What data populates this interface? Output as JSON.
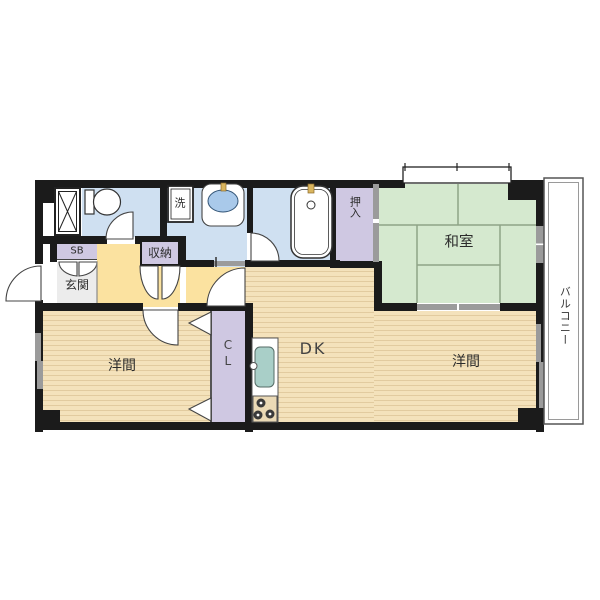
{
  "floorplan": {
    "type": "japanese-apartment-floorplan",
    "rooms": {
      "washitsu": {
        "label": "和室"
      },
      "youma_left": {
        "label": "洋間"
      },
      "youma_right": {
        "label": "洋間"
      },
      "dk": {
        "label": "DK"
      },
      "genkan": {
        "label": "玄関"
      },
      "storage": {
        "label": "収納"
      },
      "oshiire": {
        "label": "押入"
      },
      "laundry": {
        "label": "洗"
      },
      "shoebox": {
        "label": "SB"
      },
      "closet": {
        "label": "CL"
      },
      "balcony": {
        "label": "バルコニー"
      }
    },
    "colors": {
      "wall": "#1b1b1b",
      "water_rooms": "#cfe0f1",
      "tatami": "#d5e9cf",
      "tatami_line": "#8fa487",
      "closets": "#cfc8e2",
      "hallway": "#fbe2a0",
      "wood_floor": "#f4e2bb",
      "genkan_floor": "#ececec",
      "sliding_door": "#9b9b9b",
      "sink": "#a9cfc8",
      "basin": "#a9c9ea",
      "faucet": "#d9b55e"
    }
  }
}
